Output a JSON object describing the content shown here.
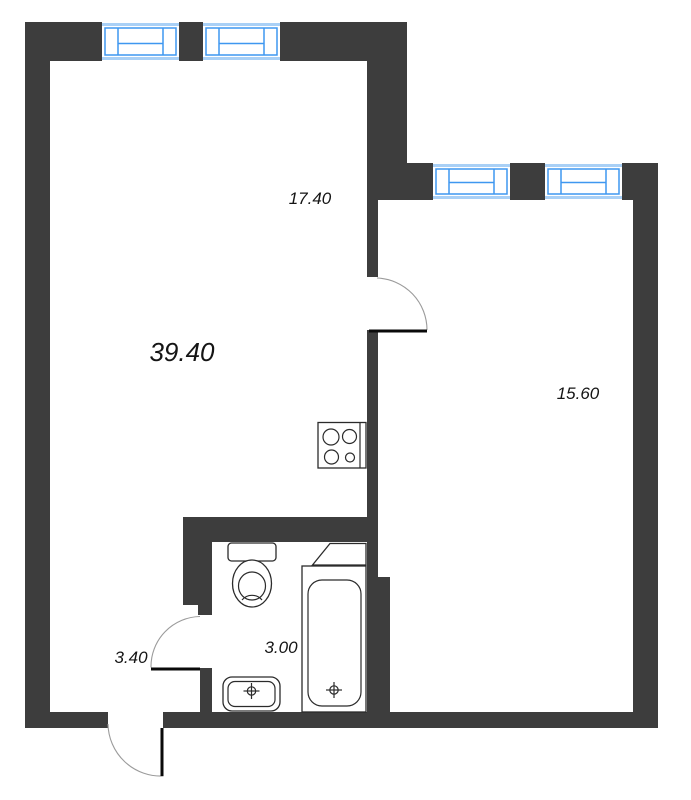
{
  "plan": {
    "type": "apartment-floor-plan",
    "labels": {
      "living_kitchen_area": "39.40",
      "living_zone_area": "17.40",
      "bedroom_area": "15.60",
      "hallway_area": "3.40",
      "bathroom_area": "3.00"
    },
    "fixtures": [
      "window-icon",
      "door-swing-icon",
      "toilet-icon",
      "bathtub-icon",
      "sink-icon",
      "stove-icon",
      "shelf-icon"
    ],
    "colors": {
      "wall": "#3d3d3d",
      "window_frame": "#3e97f0",
      "window_band": "#a9d0f6",
      "fixture_outline": "#2b2b2b",
      "door_arc": "#9b9b9b",
      "label_text": "#151515",
      "background": "#ffffff"
    }
  }
}
